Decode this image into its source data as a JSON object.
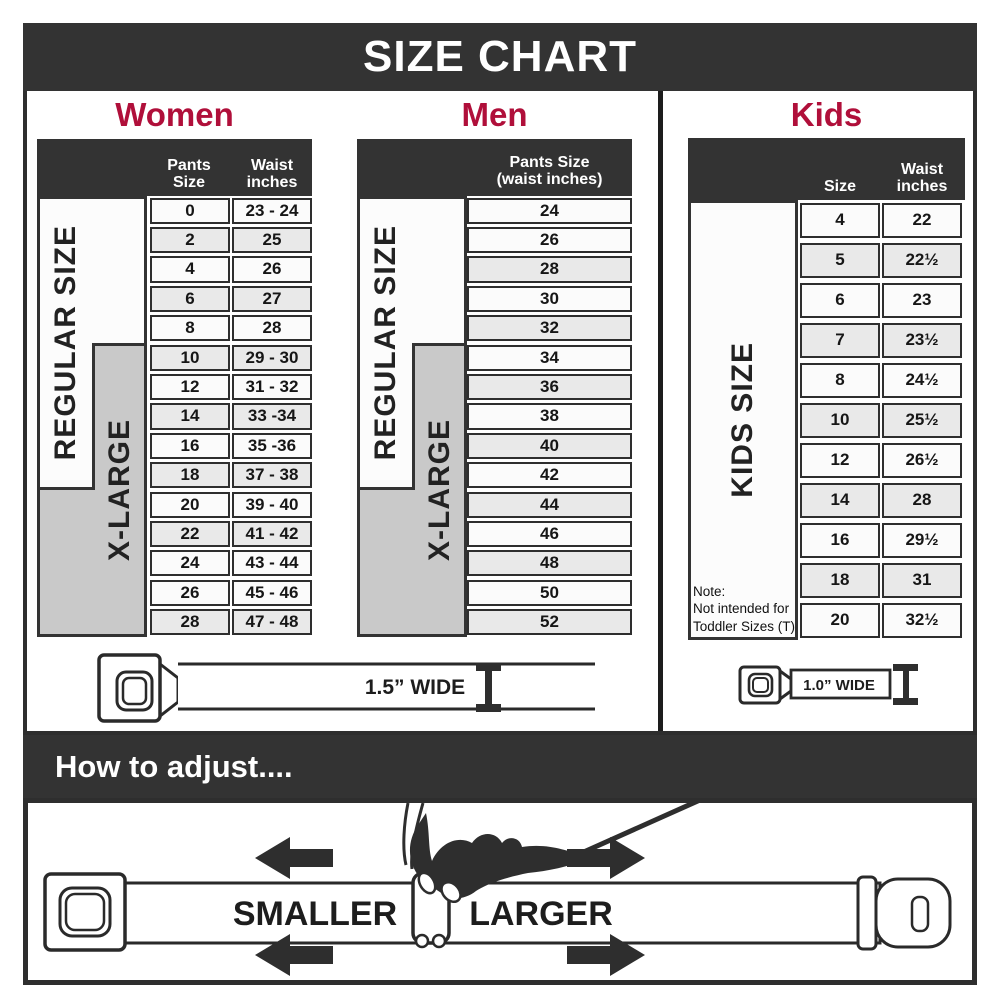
{
  "title": "SIZE CHART",
  "colors": {
    "dark": "#333333",
    "accent": "#b00f3a",
    "grey_box": "#c9c9c9",
    "row_shaded": "#e9e9e9"
  },
  "women": {
    "heading": "Women",
    "col1_header": "Pants Size",
    "col2_header": "Waist inches",
    "regular_label": "REGULAR SIZE",
    "xlarge_label": "X-LARGE",
    "rows": [
      {
        "size": "0",
        "waist": "23 - 24",
        "shaded": false
      },
      {
        "size": "2",
        "waist": "25",
        "shaded": true
      },
      {
        "size": "4",
        "waist": "26",
        "shaded": false
      },
      {
        "size": "6",
        "waist": "27",
        "shaded": true
      },
      {
        "size": "8",
        "waist": "28",
        "shaded": false
      },
      {
        "size": "10",
        "waist": "29 - 30",
        "shaded": true
      },
      {
        "size": "12",
        "waist": "31 - 32",
        "shaded": false
      },
      {
        "size": "14",
        "waist": "33 -34",
        "shaded": true
      },
      {
        "size": "16",
        "waist": "35 -36",
        "shaded": false
      },
      {
        "size": "18",
        "waist": "37 - 38",
        "shaded": true
      },
      {
        "size": "20",
        "waist": "39 - 40",
        "shaded": false
      },
      {
        "size": "22",
        "waist": "41 - 42",
        "shaded": true
      },
      {
        "size": "24",
        "waist": "43 - 44",
        "shaded": false
      },
      {
        "size": "26",
        "waist": "45 - 46",
        "shaded": false
      },
      {
        "size": "28",
        "waist": "47 - 48",
        "shaded": true
      }
    ]
  },
  "men": {
    "heading": "Men",
    "col_header_line1": "Pants Size",
    "col_header_line2": "(waist inches)",
    "regular_label": "REGULAR SIZE",
    "xlarge_label": "X-LARGE",
    "rows": [
      {
        "size": "24",
        "shaded": false
      },
      {
        "size": "26",
        "shaded": false
      },
      {
        "size": "28",
        "shaded": true
      },
      {
        "size": "30",
        "shaded": false
      },
      {
        "size": "32",
        "shaded": true
      },
      {
        "size": "34",
        "shaded": false
      },
      {
        "size": "36",
        "shaded": true
      },
      {
        "size": "38",
        "shaded": false
      },
      {
        "size": "40",
        "shaded": true
      },
      {
        "size": "42",
        "shaded": false
      },
      {
        "size": "44",
        "shaded": true
      },
      {
        "size": "46",
        "shaded": false
      },
      {
        "size": "48",
        "shaded": true
      },
      {
        "size": "50",
        "shaded": false
      },
      {
        "size": "52",
        "shaded": true
      }
    ]
  },
  "kids": {
    "heading": "Kids",
    "col1_header": "Size",
    "col2_header": "Waist inches",
    "label": "KIDS SIZE",
    "note_title": "Note:",
    "note_lines": [
      "Not intended for",
      "Toddler Sizes (T)"
    ],
    "rows": [
      {
        "size": "4",
        "waist": "22",
        "shaded": false
      },
      {
        "size": "5",
        "waist": "22½",
        "shaded": true
      },
      {
        "size": "6",
        "waist": "23",
        "shaded": false
      },
      {
        "size": "7",
        "waist": "23½",
        "shaded": true
      },
      {
        "size": "8",
        "waist": "24½",
        "shaded": false
      },
      {
        "size": "10",
        "waist": "25½",
        "shaded": true
      },
      {
        "size": "12",
        "waist": "26½",
        "shaded": false
      },
      {
        "size": "14",
        "waist": "28",
        "shaded": true
      },
      {
        "size": "16",
        "waist": "29½",
        "shaded": false
      },
      {
        "size": "18",
        "waist": "31",
        "shaded": true
      },
      {
        "size": "20",
        "waist": "32½",
        "shaded": false
      }
    ]
  },
  "belts": {
    "adult_label": "1.5” WIDE",
    "kids_label": "1.0” WIDE"
  },
  "how_to_adjust": {
    "heading": "How to adjust....",
    "smaller_label": "SMALLER",
    "larger_label": "LARGER"
  }
}
